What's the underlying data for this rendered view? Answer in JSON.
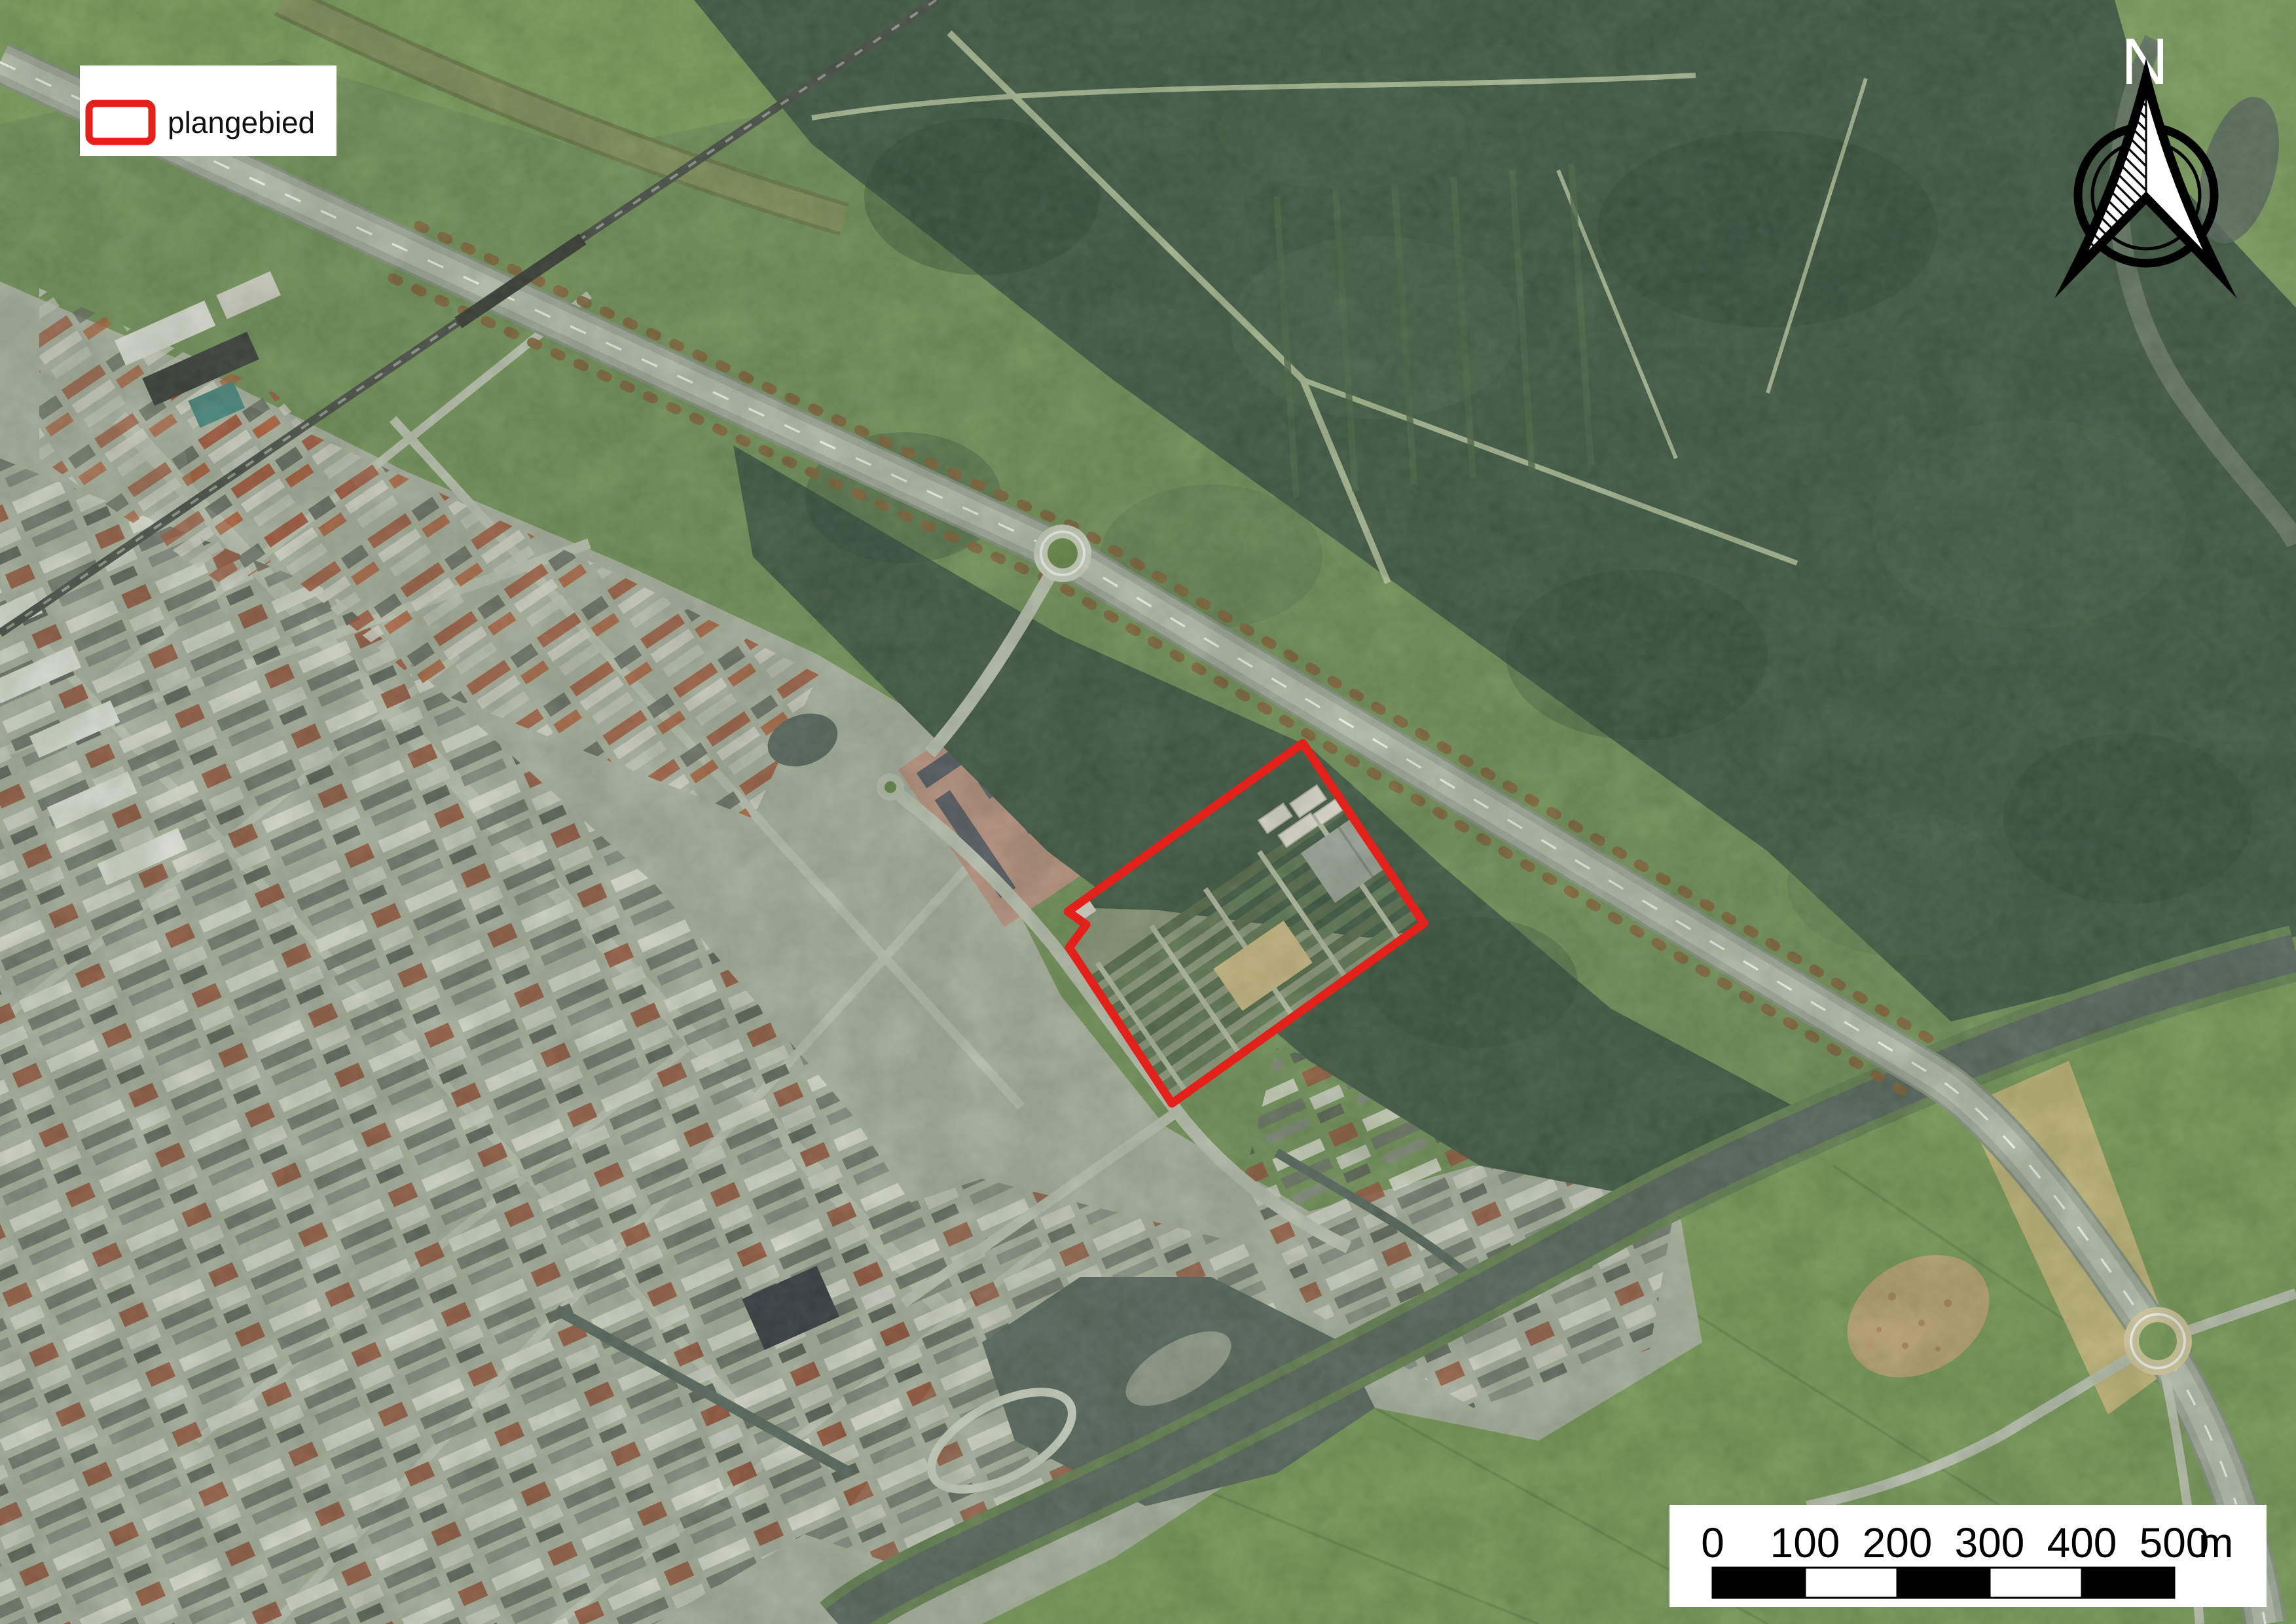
{
  "legend": {
    "label": "plangebied"
  },
  "north_arrow": {
    "label": "N"
  },
  "scale_bar": {
    "labels": [
      "0",
      "100",
      "200",
      "300",
      "400",
      "500"
    ],
    "unit": "m"
  },
  "colors": {
    "plangebied_red": "#e3211a",
    "forest": "#46604a",
    "field": "#7fa35f",
    "meadow": "#7a9a60",
    "urban": "#b4bba9",
    "water": "#5e6f66",
    "road": "#c6ccbb",
    "highway_pavement": "#aab4a6",
    "rail": "#4f554d",
    "tan": "#d5c286",
    "panel_background": "#ffffff",
    "scalebar_black": "#000000",
    "label_text": "#111111"
  }
}
